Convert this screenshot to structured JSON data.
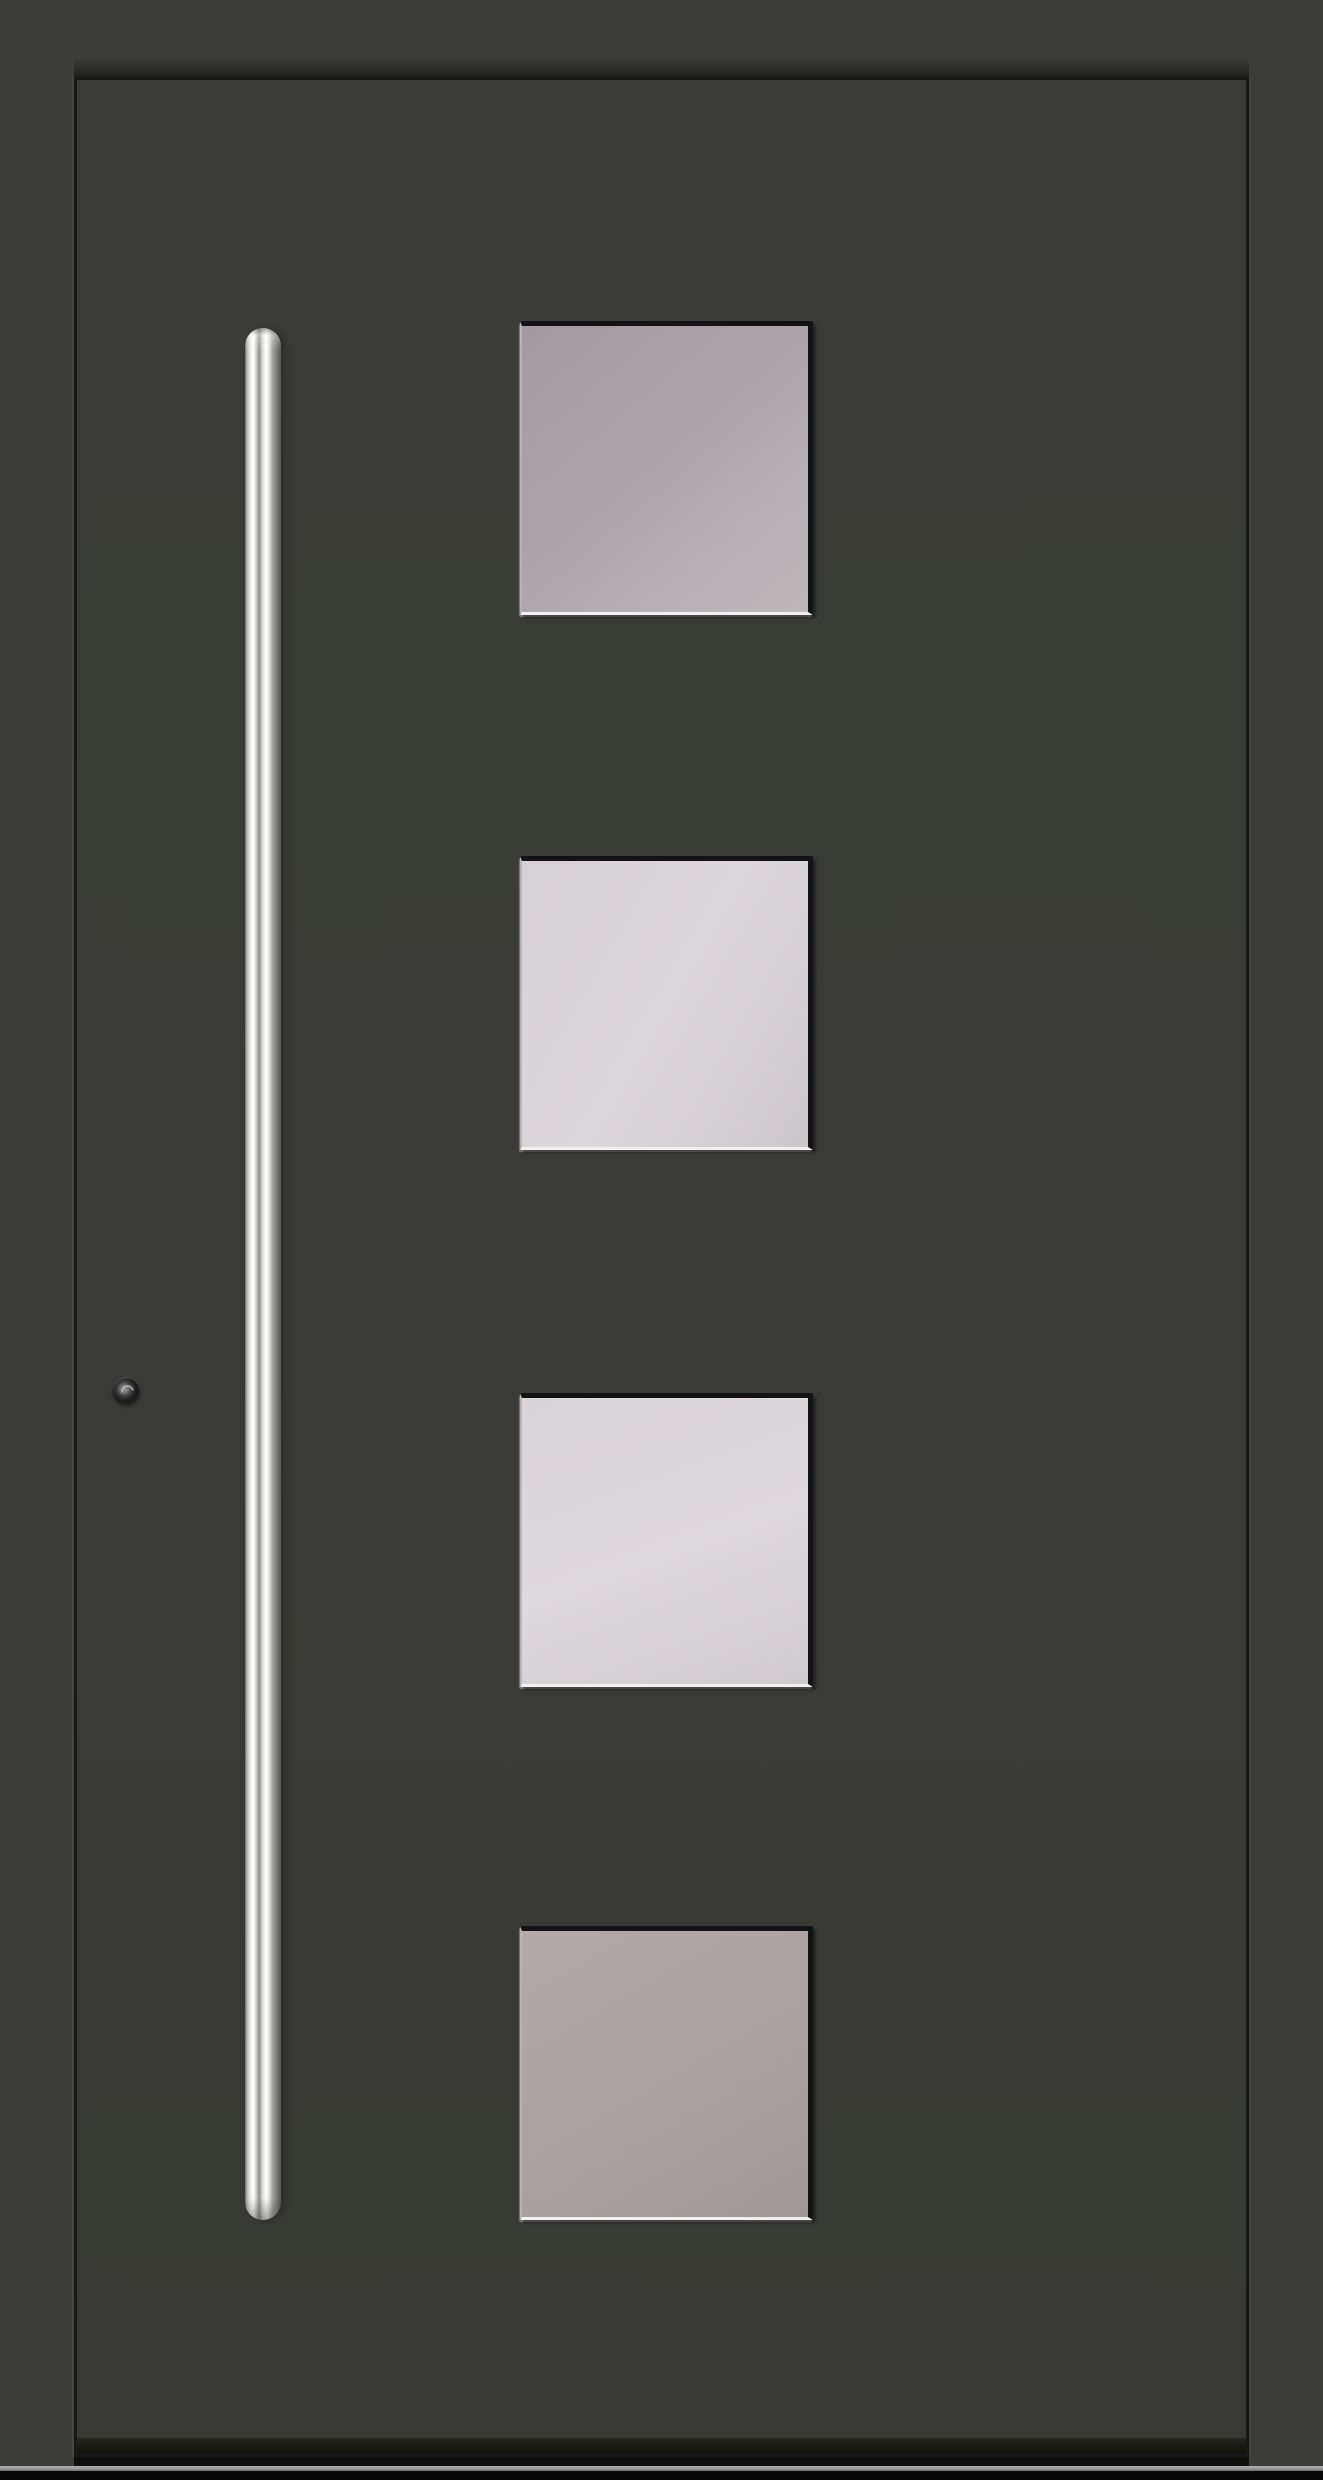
{
  "scene": {
    "type": "product-photo",
    "subject": "modern aluminium entrance door, closed, front view",
    "door_finish": "anthracite grey, matt",
    "glass_panel_count": 4,
    "handle_style": "full-height fluted stainless-steel pull bar",
    "lock_style": "round security cylinder rosette"
  },
  "colors": {
    "frame-color": "#3d3e39",
    "leaf-color": "#3b3c37",
    "outline-color": "#17181a",
    "kick-color": "#1b1c17",
    "glass-edge-dark": "#121314",
    "glass-edge-light": "#f2f0f2",
    "glass1-a": "#a29aa0",
    "glass1-b": "#bfb9bc",
    "glass2-a": "#d6d1d5",
    "glass2-b": "#ccc7cb",
    "glass3-a": "#dad5d9",
    "glass3-b": "#cfcace",
    "glass4-a": "#b3abaa",
    "glass4-b": "#a19998",
    "handle-steel": "#e8e8e6",
    "lock-color": "#191919",
    "floorline-color": "#98989a",
    "floor-color": "#060606"
  },
  "door": {
    "panels": [
      {
        "id": "glass-panel-1",
        "tone": "mid smoked grey"
      },
      {
        "id": "glass-panel-2",
        "tone": "light frosted white"
      },
      {
        "id": "glass-panel-3",
        "tone": "light frosted white"
      },
      {
        "id": "glass-panel-4",
        "tone": "mid warm grey"
      }
    ],
    "handle": {
      "side": "left",
      "material": "stainless steel"
    },
    "lock": {
      "position": "left stile, mid-height"
    }
  }
}
